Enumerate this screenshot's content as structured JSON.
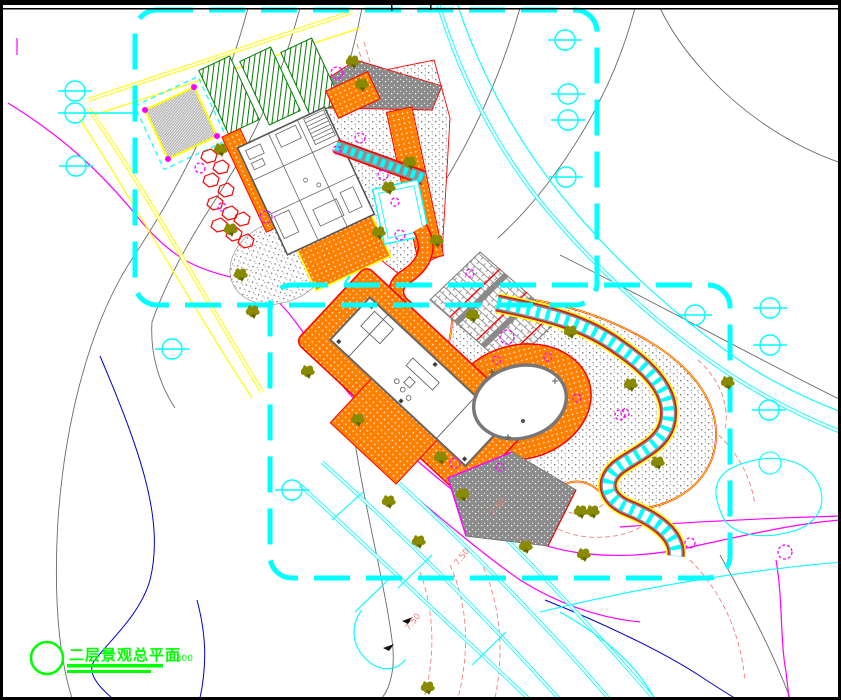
{
  "drawing": {
    "title": "二层景观总平面",
    "scale": "1:300",
    "type": "landscape-master-plan"
  },
  "annotations": {
    "spot_elevations": [
      "7.50",
      "7.50",
      "7.50"
    ]
  },
  "palette": {
    "boundary_dash_cyan": "#00ffff",
    "road_edge_yellow": "#ffff00",
    "paving_orange": "#ff8000",
    "outline_red": "#ff0000",
    "property_line_magenta": "#ff00ff",
    "contour_gray": "#6a6a6a",
    "contour_salmon": "#f08080",
    "water_blue": "#0000cd",
    "planting_green": "#007f00",
    "tree_olive": "#8a8a00",
    "title_green": "#00ff00",
    "frame_black": "#000000"
  },
  "symbols": {
    "survey_marker": "circle-with-axis-line",
    "tree": "olive-sprig",
    "shrub": "magenta-dashed-circle",
    "title_bubble": "green-circle"
  }
}
